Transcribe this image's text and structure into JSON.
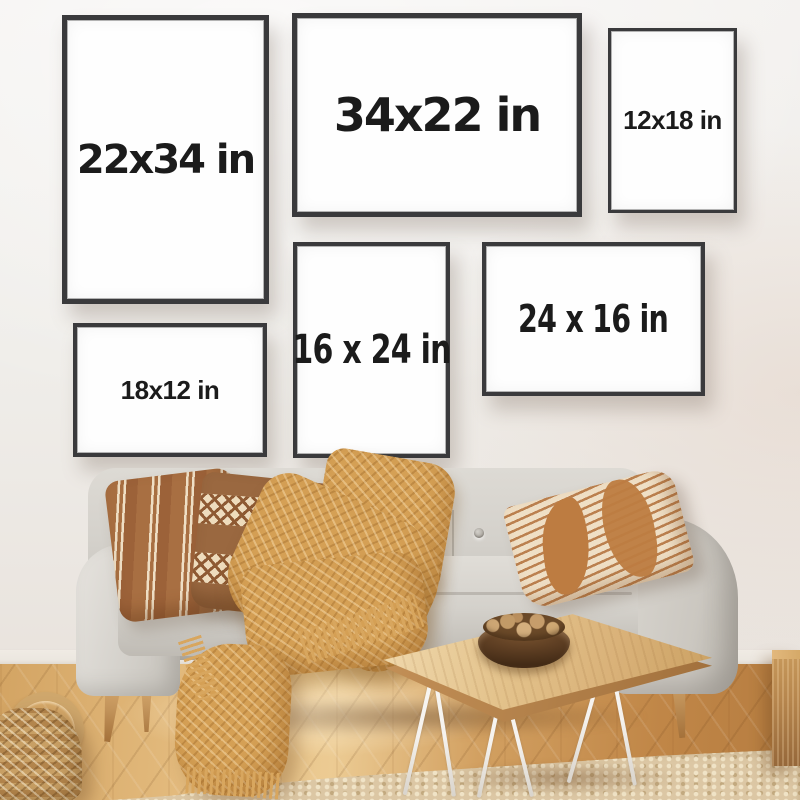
{
  "frames": [
    {
      "label": "22x34 in",
      "orientation": "portrait"
    },
    {
      "label": "34x22 in",
      "orientation": "landscape"
    },
    {
      "label": "12x18 in",
      "orientation": "portrait"
    },
    {
      "label": "16 x 24 in",
      "orientation": "portrait"
    },
    {
      "label": "24 x 16 in",
      "orientation": "landscape"
    },
    {
      "label": "18x12 in",
      "orientation": "landscape"
    }
  ],
  "palette": {
    "wall": "#f1efec",
    "frame-border": "#3a3a3c",
    "frame-face": "#fefefe",
    "label-ink": "#1b1b1b",
    "floor-light": "#eccb93",
    "floor-mid": "#d2a061",
    "floor-dark": "#b57c40",
    "baseboard": "#ece7e0",
    "rug": "#dcc7a4",
    "sofa": "#d4d1cb",
    "sofa-shadow": "#b3afa7",
    "pillow-rust": "#a86f42",
    "pillow-cream": "#efdfc5",
    "pillow-brown": "#9a6840",
    "blanket": "#d5a055",
    "table-wood": "#e3c28b",
    "hairpin-leg": "#f5f2ee",
    "bowl": "#5c3d22",
    "nuts": "#c9a26e",
    "basket": "#c49a60",
    "wood-cube": "#b5854d",
    "leg-wood": "#c2935a"
  }
}
